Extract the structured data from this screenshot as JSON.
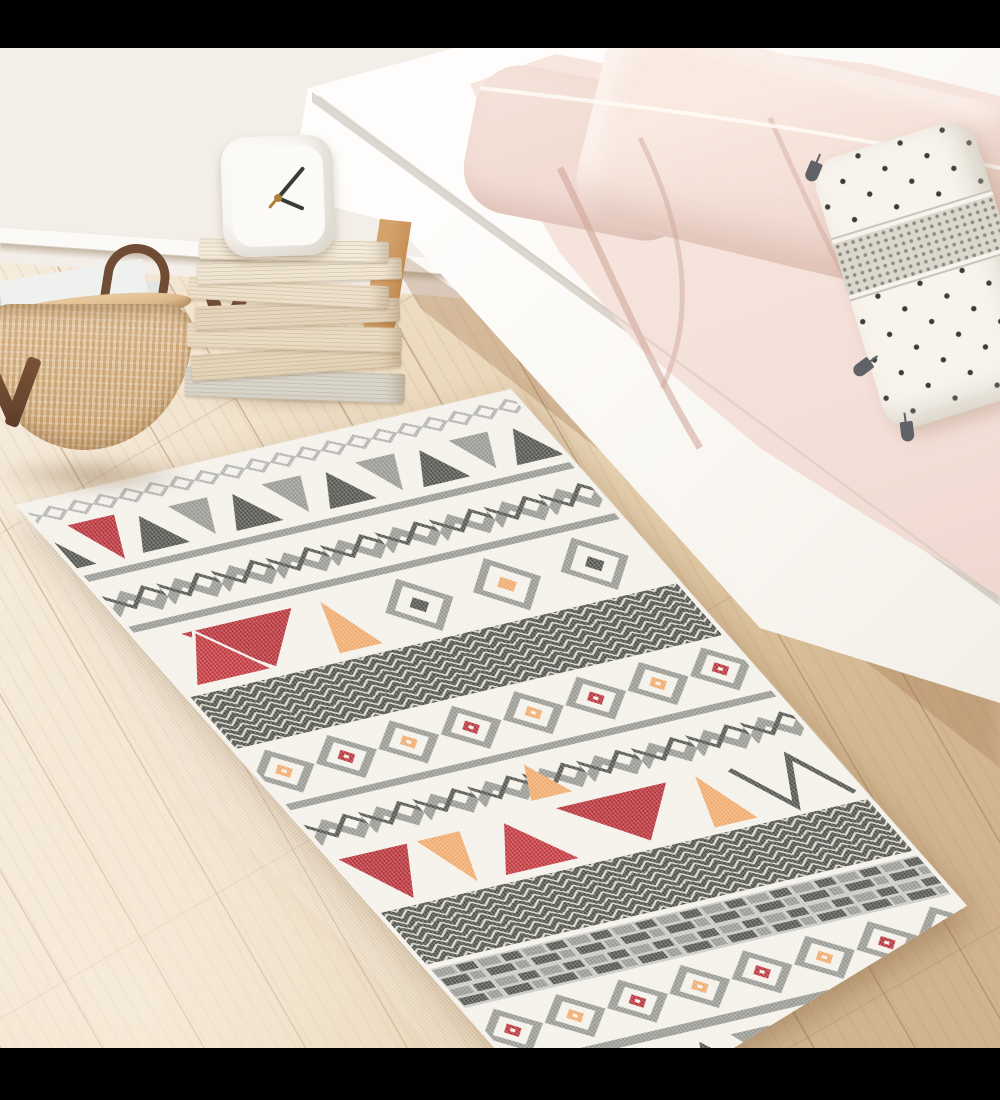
{
  "scene": {
    "type": "product-photo",
    "description": "Bedroom photograph: bohemian geometric runner rug laid diagonally on a pale wood plank floor, beside a low white bed with blush-pink bedding, a polka-dot tassel cushion, a stack of cream books topped by a white desk clock, and a woven basket of magazines against a white wall. Black letterbox bars at top and bottom.",
    "objects": [
      {
        "name": "letterbox-bars",
        "detail": "black bands across the very top and bottom of the image"
      },
      {
        "name": "wall",
        "detail": "plain warm-white wall with white skirting board"
      },
      {
        "name": "wood-floor",
        "detail": "light oak planks running diagonally toward upper right"
      },
      {
        "name": "bed",
        "detail": "white low bed frame with angled wooden leg, white sheet, blush pink duvet and pillows"
      },
      {
        "name": "dotted-pillow",
        "detail": "white cushion with black polka dots, woven grey centre band and dark grey corner tassels"
      },
      {
        "name": "basket",
        "detail": "round woven rattan basket with dark brown leather handles holding white magazines"
      },
      {
        "name": "book-stack",
        "detail": "seven cream and beige books stacked loosely with a leather strap"
      },
      {
        "name": "clock",
        "detail": "white rounded-square table clock with dark hands and brass centre"
      },
      {
        "name": "rug",
        "detail": "aztec/kilim style runner with bands of zigzags, triangles, herringbone, diamond medallions and brick motifs in grey, charcoal, red and apricot on ivory"
      }
    ]
  },
  "palette": {
    "letterbox": "#000000",
    "wall": "#f3eee8",
    "skirting": "#fbfaf6",
    "floor_light": "#f6ecdc",
    "floor_mid": "#ecd9bd",
    "floor_dark": "#d9bf9d",
    "frame_white": "#f9f6f1",
    "leg_wood": "#c89158",
    "bedding_pink": "#f3ded7",
    "bedding_pink_deep": "#e8cbc2",
    "sheet_white": "#f8f4ed",
    "pillow_dot": "#3b3b39",
    "pillow_band": "#dbd7cd",
    "tassel_grey": "#5f6266",
    "basket_tan": "#debb8e",
    "handle_brown": "#6f4c33",
    "magazine_grey": "#e2e6e3",
    "book_cream": "#f0e6d3",
    "book_grey": "#d8d5cb",
    "clock_white": "#fdfcfa",
    "clock_hand": "#3a3a37",
    "clock_gold": "#ad8035",
    "rug_base": "#f4f1ea",
    "rug_lgrey": "#b3b3b1",
    "rug_grey": "#9a9a94",
    "rug_charcoal": "#54564f",
    "rug_red": "#b8353c",
    "rug_orange": "#f0ab6e"
  }
}
